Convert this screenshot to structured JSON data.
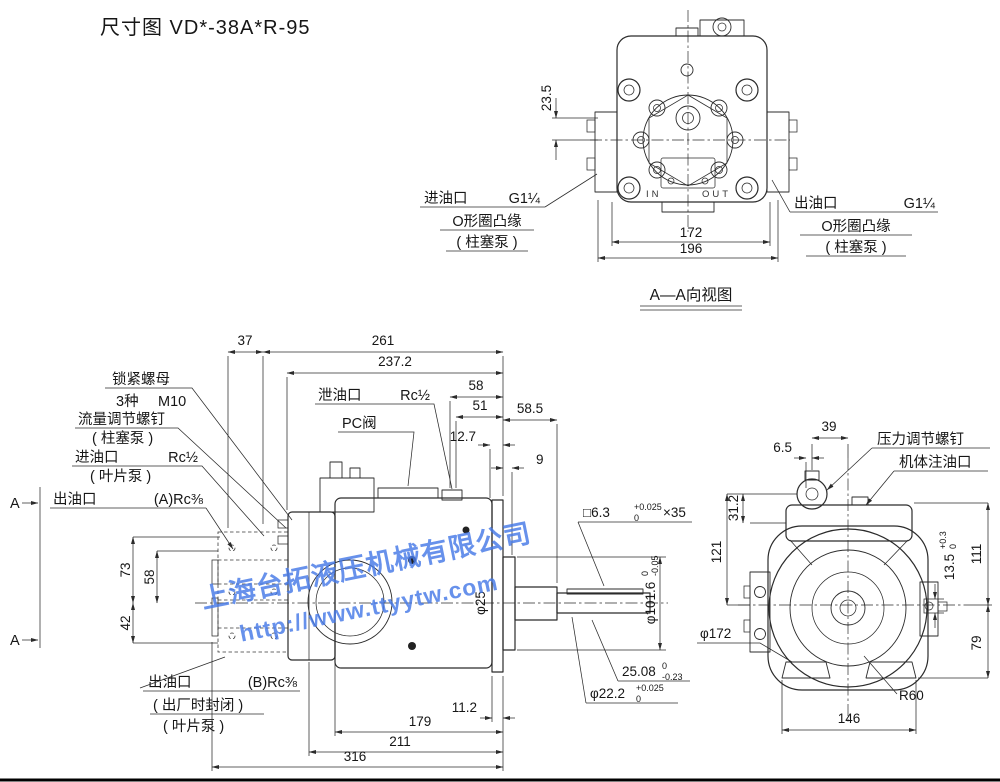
{
  "page": {
    "title": "尺寸图 VD*-38A*R-95"
  },
  "watermark": {
    "company": "上海台拓液压机械有限公司",
    "url": "http://www.ttyytw.com",
    "color": "#4579e6"
  },
  "top_view": {
    "caption": "A—A向视图",
    "port_marks": {
      "in": "IN",
      "out": "OUT"
    },
    "inlet": {
      "name": "进油口",
      "size": "G1¼",
      "flange": "O形圈凸缘",
      "pump": "( 柱塞泵 )"
    },
    "outlet": {
      "name": "出油口",
      "size": "G1¼",
      "flange": "O形圈凸缘",
      "pump": "( 柱塞泵 )"
    },
    "dims": {
      "top_offset": "23.5",
      "bolt_span": "172",
      "overall_width": "196"
    }
  },
  "side_view": {
    "section_marker": "A",
    "dims_top": {
      "d37": "37",
      "d261": "261",
      "d237_2": "237.2",
      "d58": "58",
      "d51": "51",
      "d58_5": "58.5",
      "d12_7": "12.7",
      "d9": "9"
    },
    "dims_left": {
      "d73": "73",
      "d58": "58",
      "d42": "42"
    },
    "dims_bottom": {
      "d11_2": "11.2",
      "d179": "179",
      "d211": "211",
      "d316": "316"
    },
    "labels": {
      "drain": {
        "name": "泄油口",
        "size": "Rc½"
      },
      "pc_valve": "PC阀",
      "lock_nut": {
        "line1": "锁紧螺母",
        "qty": "3种",
        "thread": "M10"
      },
      "flow_screw": {
        "line1": "流量调节螺钉",
        "line2": "( 柱塞泵 )"
      },
      "inlet": {
        "name": "进油口",
        "size": "Rc½",
        "pump": "( 叶片泵 )"
      },
      "outlet_a": {
        "name": "出油口",
        "size": "(A)Rc⅜"
      },
      "outlet_b": {
        "name": "出油口",
        "size": "(B)Rc⅜",
        "note": "( 出厂时封闭 )",
        "pump": "( 叶片泵 )"
      }
    },
    "annotations": {
      "key": {
        "prefix": "□6.3",
        "tol_top": "+0.025",
        "tol_bottom": "0",
        "suffix": "×35"
      },
      "pilot": {
        "value": "φ101.6",
        "tol_top": "0",
        "tol_bottom": "-0.05"
      },
      "key_height": {
        "value": "25.08",
        "tol_top": "0",
        "tol_bottom": "-0.23"
      },
      "shaft": {
        "value": "φ22.2",
        "tol_top": "+0.025",
        "tol_bottom": "0"
      },
      "hub": "φ25"
    }
  },
  "rear_view": {
    "labels": {
      "pressure_screw": "压力调节螺钉",
      "filler_port": "机体注油口"
    },
    "dims": {
      "d39": "39",
      "d6_5": "6.5",
      "d31_2": "31.2",
      "d121": "121",
      "key_slot": {
        "value": "13.5",
        "tol_top": "+0.3",
        "tol_bottom": "0"
      },
      "d111": "111",
      "d79": "79",
      "pilot_dia": "φ172",
      "radius": "R60",
      "d146": "146"
    }
  }
}
